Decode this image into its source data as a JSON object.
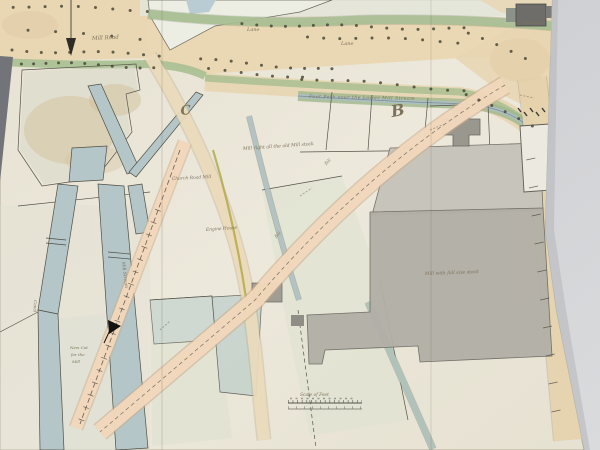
{
  "photo": {
    "background_color": "#cdced1",
    "shadow_left_color": "#73747a"
  },
  "map": {
    "paper_color": "#eae6d9",
    "ink_color": "#57534a",
    "colors": {
      "road_tan": "#ead7b4",
      "proposal_salmon": "#f2d8bc",
      "verge_green": "#a9bf92",
      "water_blue": "#b4c6c8",
      "building_gray": "#b2afa7",
      "building_dark_gray": "#6e6d69"
    },
    "markers": {
      "a": "A",
      "b": "B",
      "c": "C"
    },
    "annotations": {
      "road_top": "Mill Road",
      "lane_1": "Lane",
      "lane_2": "Lane",
      "footpath": "Foot Path over the Lower Mill Stream",
      "field_note": "Mill right all the old Mill stock",
      "church_road": "Church Road Mill",
      "engine": "Engine House",
      "mill_note": "Mill with full size stock",
      "st_house": "St House",
      "stream_vertical": "Mill Stream",
      "canal": "Canal",
      "water_note_1": "New Cut",
      "water_note_2": "for the",
      "water_note_3": "Mill",
      "fall_1": "fall",
      "fall_2": "fall",
      "scale_label": "Scale of Feet"
    }
  }
}
